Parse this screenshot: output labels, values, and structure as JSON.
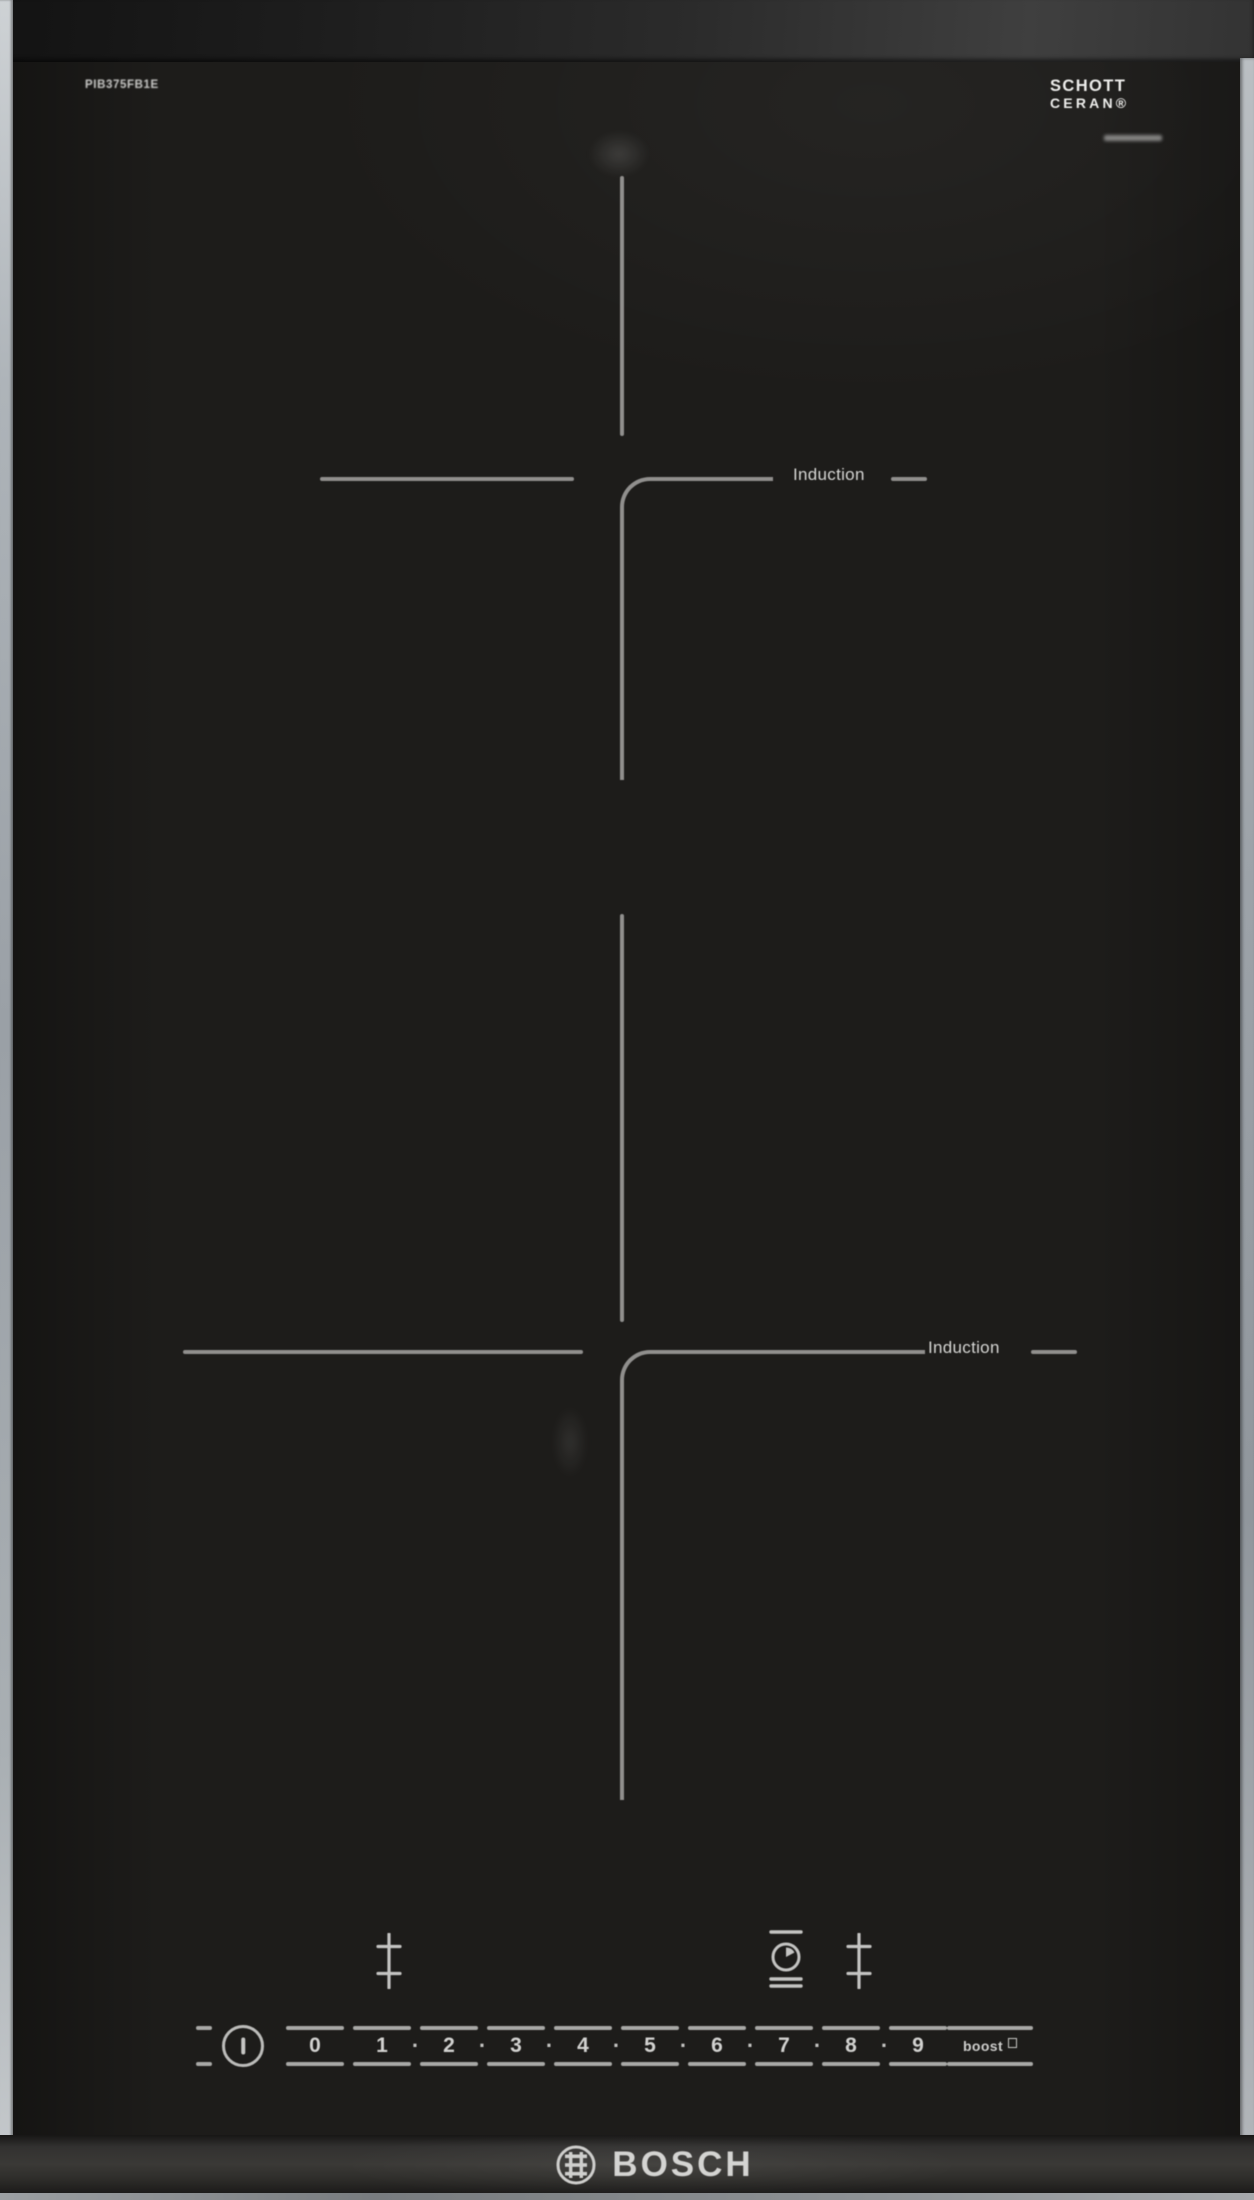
{
  "header": {
    "model_number": "PIB375FB1E",
    "ceran_logo_line1": "SCHOTT",
    "ceran_logo_line2": "CERAN®"
  },
  "cooking_zones": {
    "zone1_label": "Induction",
    "zone2_label": "Induction"
  },
  "control_panel": {
    "power_levels": [
      "0",
      "1",
      "2",
      "3",
      "4",
      "5",
      "6",
      "7",
      "8",
      "9"
    ],
    "level_separator": "·",
    "boost_label": "boost"
  },
  "footer": {
    "brand": "BOSCH"
  },
  "icons": {
    "power": "power-icon",
    "timer": "timer-clock-icon",
    "zone_select": "zone-select-cross-icon",
    "boost_square": "boost-square-icon",
    "bosch_armature": "bosch-armature-icon"
  },
  "colors": {
    "glass_surface": "#1d1c1a",
    "zone_marking": "#908f8d",
    "control_text": "#d2d2d0",
    "edge_trim": "#aab0b5",
    "logo_text": "#d4d4d2"
  }
}
